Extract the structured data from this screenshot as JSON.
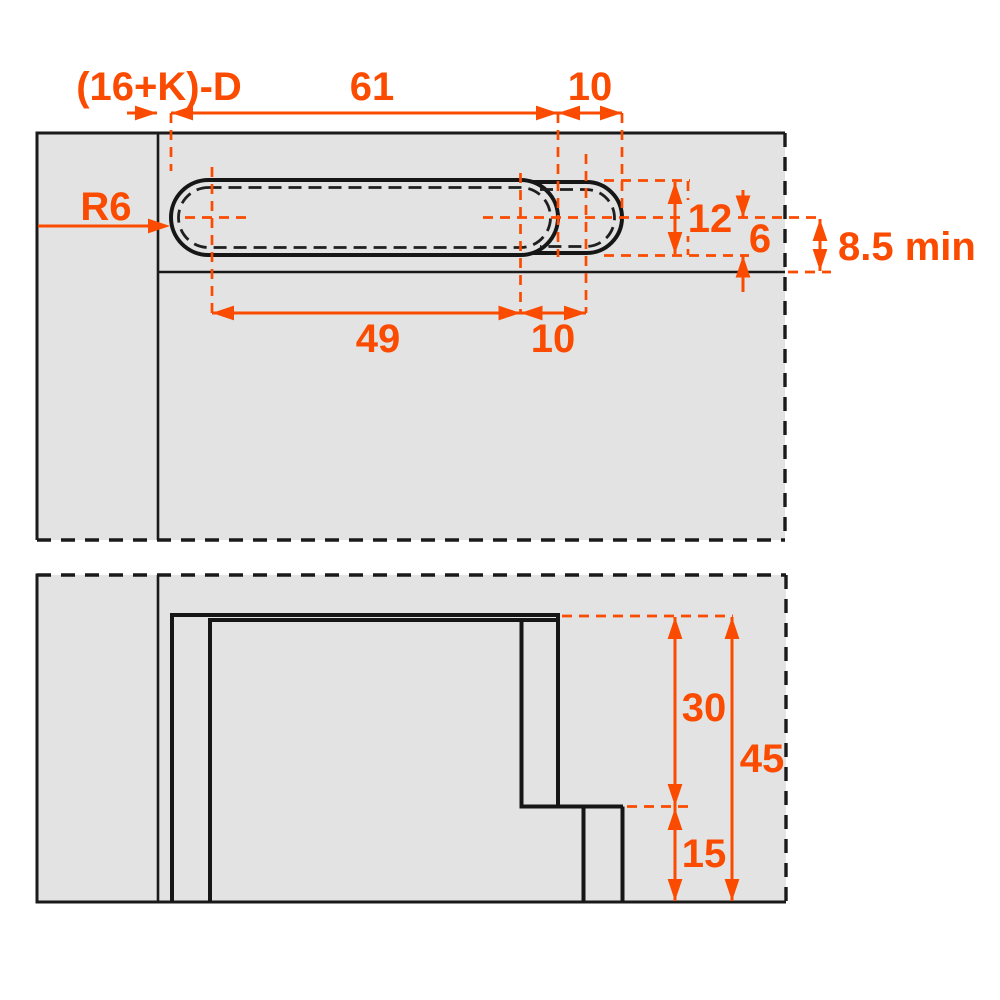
{
  "drawing": {
    "type": "technical-dimension-drawing",
    "colors": {
      "accent": "#fa4b00",
      "panel_fill": "#e2e3e2",
      "line": "#1a1a1a",
      "background": "#ffffff"
    },
    "top_view": {
      "dim_offset": "(16+K)-D",
      "dim_length_outer": "61",
      "dim_step_outer": "10",
      "radius": "R6",
      "dim_width": "12",
      "dim_half_width": "6",
      "dim_edge_min": "8.5 min",
      "dim_length_centers": "49",
      "dim_step_centers": "10"
    },
    "section_view": {
      "dim_depth_upper": "30",
      "dim_depth_total": "45",
      "dim_depth_lower": "15"
    }
  }
}
